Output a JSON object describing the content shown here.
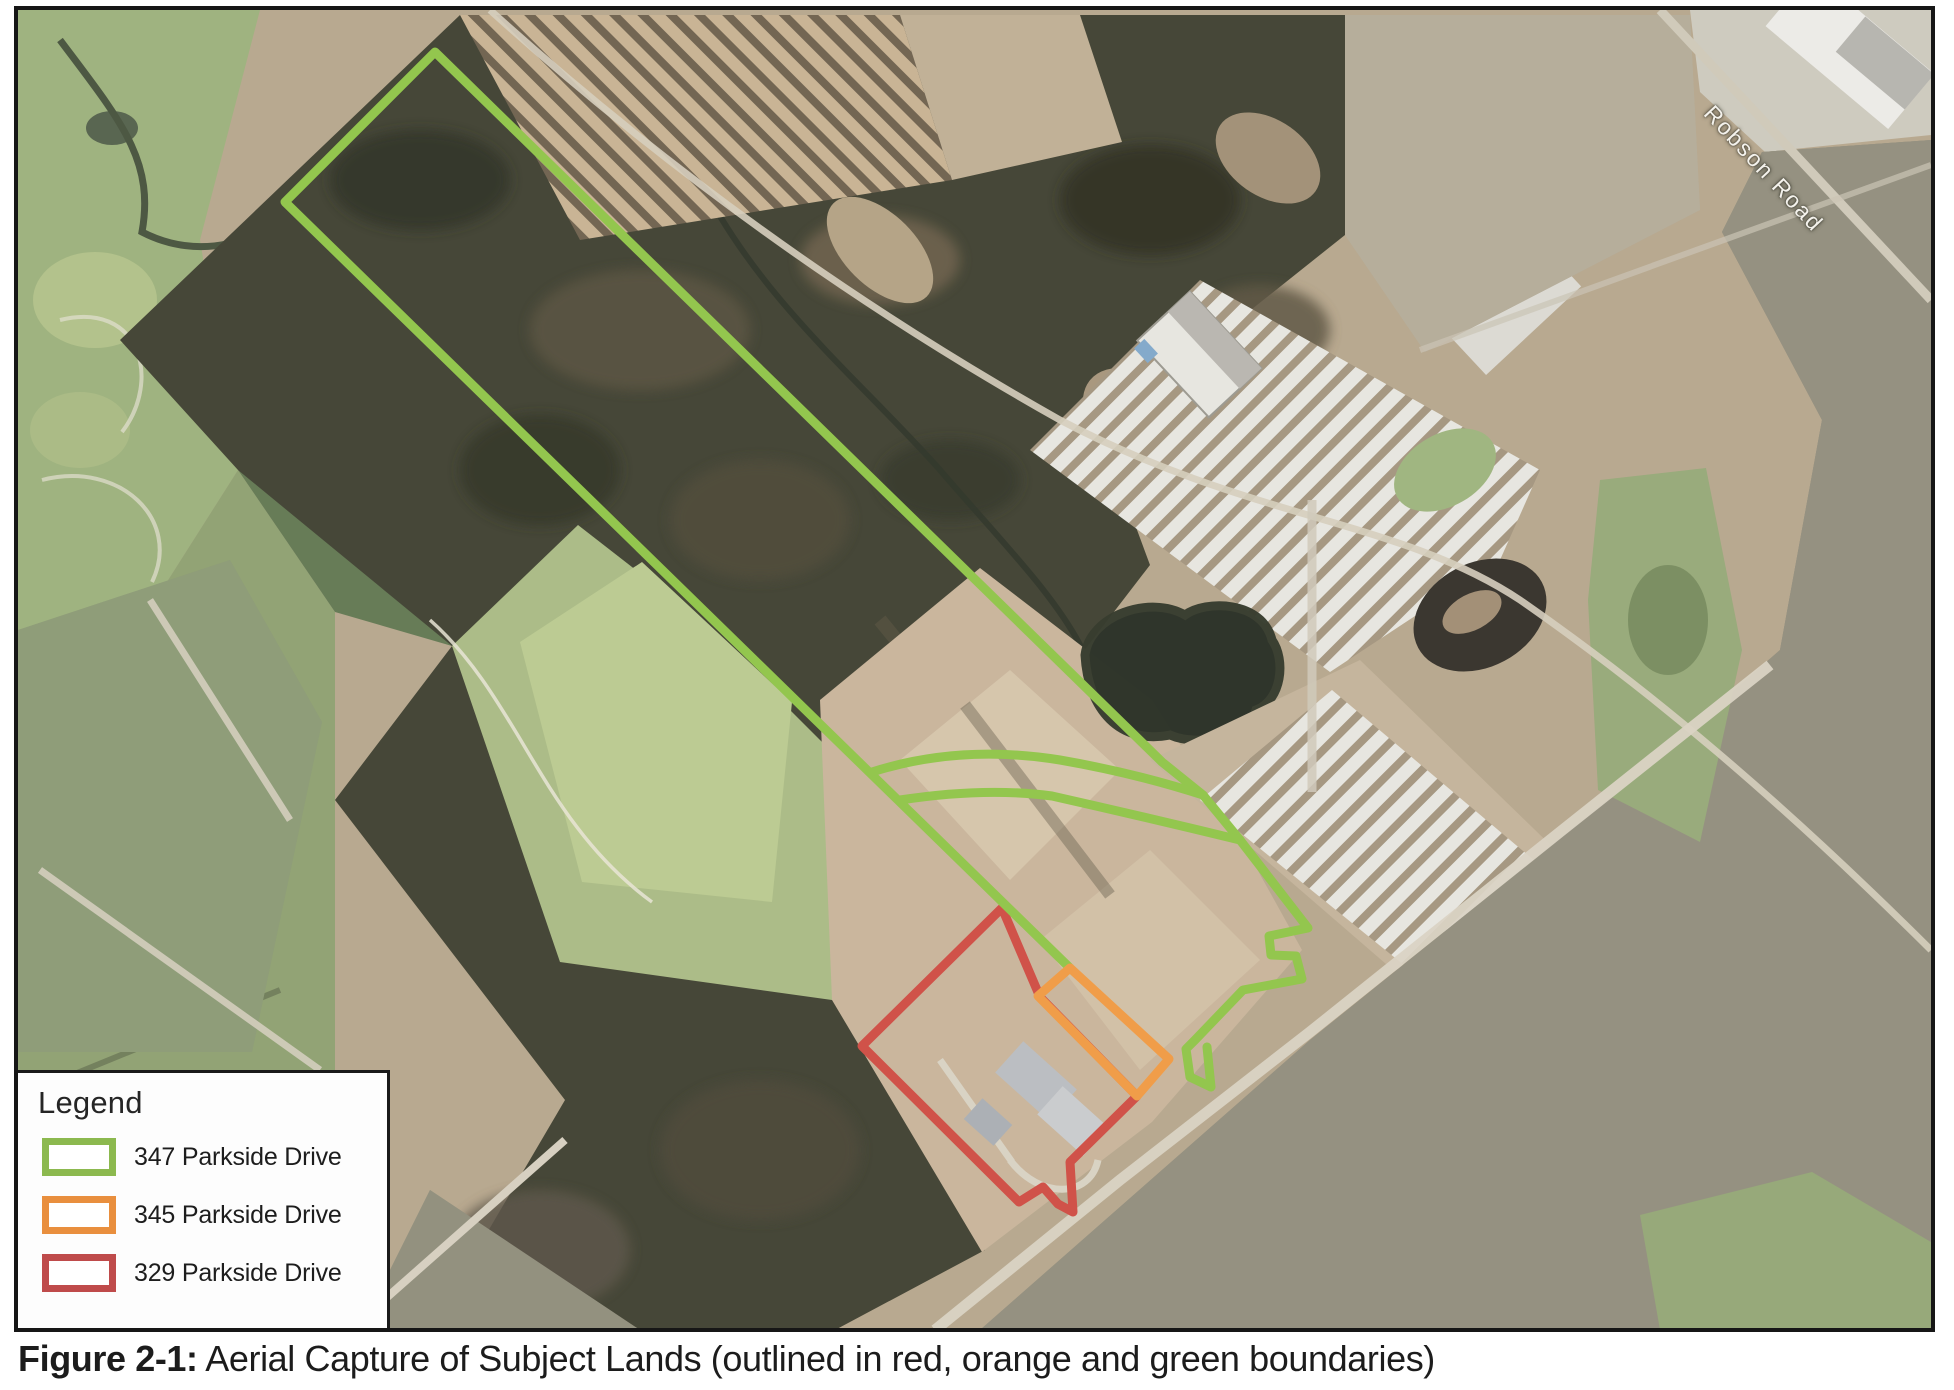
{
  "figure": {
    "label": "Figure 2-1:",
    "caption": " Aerial Capture of Subject Lands (outlined in red, orange and green boundaries)"
  },
  "map": {
    "type": "aerial-photograph",
    "road_label": "Robson Road"
  },
  "legend": {
    "title": "Legend",
    "items": [
      {
        "label": "347 Parkside Drive",
        "color": "#8cb94f"
      },
      {
        "label": "345 Parkside Drive",
        "color": "#e98f3e"
      },
      {
        "label": "329 Parkside Drive",
        "color": "#bf4b4b"
      }
    ]
  },
  "overlays": [
    {
      "name": "347-parkside-boundary",
      "color": "#8fc447"
    },
    {
      "name": "345-parkside-boundary",
      "color": "#f09a42"
    },
    {
      "name": "329-parkside-boundary",
      "color": "#cf4b42"
    }
  ]
}
